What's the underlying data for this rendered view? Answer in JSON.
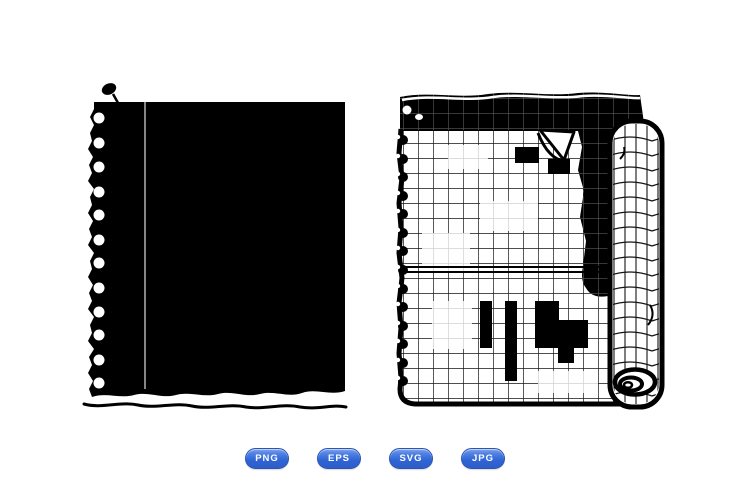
{
  "page": {
    "background_color": "#ffffff",
    "ink_color": "#000000"
  },
  "artworks": [
    {
      "name": "torn-notebook-paper-silhouette",
      "style": "solid black silhouette, pinned, punch holes, torn bottom edge"
    },
    {
      "name": "curled-graph-paper-notebook-page",
      "style": "grid notebook page, torn top strip, rolled right edge, spiral binding holes"
    }
  ],
  "badges": {
    "accent_color": "#2f64d5",
    "accent_dark_color": "#2a55bb",
    "text_color": "#ffffff",
    "items": [
      {
        "label": "PNG"
      },
      {
        "label": "EPS"
      },
      {
        "label": "SVG"
      },
      {
        "label": "JPG"
      }
    ]
  }
}
